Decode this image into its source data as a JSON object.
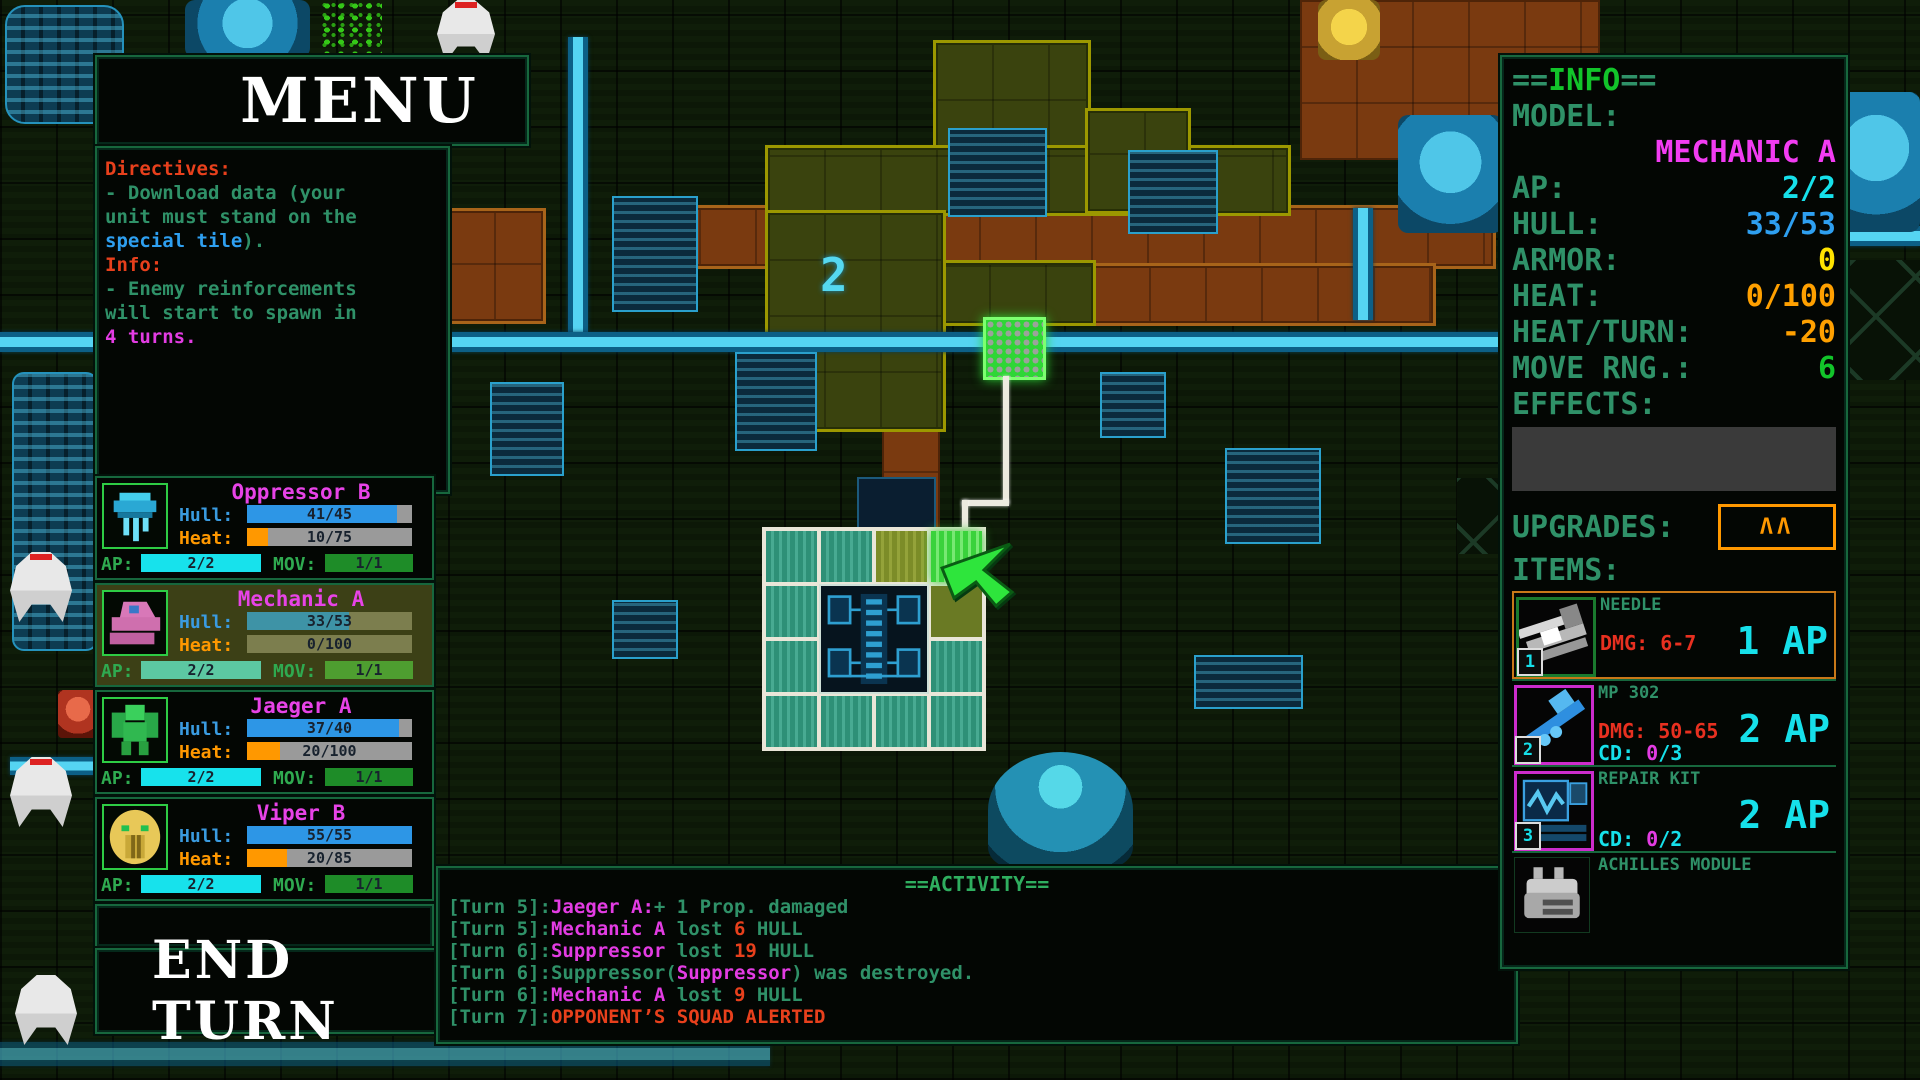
{
  "menu": {
    "title": "MENU"
  },
  "directives": {
    "lines": [
      [
        {
          "t": "Directives:",
          "c": "red"
        }
      ],
      [
        {
          "t": "- Download data (your",
          "c": "green"
        }
      ],
      [
        {
          "t": "unit must stand on the",
          "c": "green"
        }
      ],
      [
        {
          "t": "special tile",
          "c": "blue"
        },
        {
          "t": ").",
          "c": "green"
        }
      ],
      [
        {
          "t": "Info:",
          "c": "red"
        }
      ],
      [
        {
          "t": "- Enemy reinforcements",
          "c": "green"
        }
      ],
      [
        {
          "t": "will start to spawn in",
          "c": "green"
        }
      ],
      [
        {
          "t": "4 turns.",
          "c": "magenta"
        }
      ]
    ]
  },
  "squad": {
    "hull_label": "Hull:",
    "heat_label": "Heat:",
    "ap_label": "AP:",
    "mov_label": "MOV:",
    "units": [
      {
        "name": "Oppressor B",
        "sprite": "drone",
        "selected": false,
        "hull": {
          "text": "41/45",
          "pct": 91
        },
        "heat": {
          "text": "10/75",
          "pct": 13
        },
        "ap": {
          "text": "2/2",
          "pct": 100
        },
        "mov": {
          "text": "1/1",
          "pct": 100
        }
      },
      {
        "name": "Mechanic A",
        "sprite": "truck",
        "selected": true,
        "hull": {
          "text": "33/53",
          "pct": 62
        },
        "heat": {
          "text": "0/100",
          "pct": 0
        },
        "ap": {
          "text": "2/2",
          "pct": 100
        },
        "mov": {
          "text": "1/1",
          "pct": 100
        }
      },
      {
        "name": "Jaeger A",
        "sprite": "mech",
        "selected": false,
        "hull": {
          "text": "37/40",
          "pct": 92
        },
        "heat": {
          "text": "20/100",
          "pct": 20
        },
        "ap": {
          "text": "2/2",
          "pct": 100
        },
        "mov": {
          "text": "1/1",
          "pct": 100
        }
      },
      {
        "name": "Viper B",
        "sprite": "lion",
        "selected": false,
        "hull": {
          "text": "55/55",
          "pct": 100
        },
        "heat": {
          "text": "20/85",
          "pct": 24
        },
        "ap": {
          "text": "2/2",
          "pct": 100
        },
        "mov": {
          "text": "1/1",
          "pct": 100
        }
      }
    ]
  },
  "end_turn": {
    "label": "END TURN"
  },
  "activity": {
    "title": "==ACTIVITY==",
    "lines": [
      [
        {
          "t": "[Turn 5]:",
          "c": "green"
        },
        {
          "t": "Jaeger A:",
          "c": "magenta"
        },
        {
          "t": "+ 1 Prop. damaged",
          "c": "green"
        }
      ],
      [
        {
          "t": "[Turn 5]:",
          "c": "green"
        },
        {
          "t": "Mechanic A",
          "c": "magenta"
        },
        {
          "t": " lost ",
          "c": "green"
        },
        {
          "t": "6",
          "c": "red"
        },
        {
          "t": " HULL",
          "c": "green"
        }
      ],
      [
        {
          "t": "[Turn 6]:",
          "c": "green"
        },
        {
          "t": "Suppressor",
          "c": "magenta"
        },
        {
          "t": " lost ",
          "c": "green"
        },
        {
          "t": "19",
          "c": "red"
        },
        {
          "t": " HULL",
          "c": "green"
        }
      ],
      [
        {
          "t": "[Turn 6]:",
          "c": "green"
        },
        {
          "t": "Suppressor(",
          "c": "green"
        },
        {
          "t": "Suppressor",
          "c": "magenta"
        },
        {
          "t": ") was destroyed.",
          "c": "green"
        }
      ],
      [
        {
          "t": "[Turn 6]:",
          "c": "green"
        },
        {
          "t": "Mechanic A",
          "c": "magenta"
        },
        {
          "t": " lost ",
          "c": "green"
        },
        {
          "t": "9",
          "c": "red"
        },
        {
          "t": " HULL",
          "c": "green"
        }
      ],
      [
        {
          "t": "[Turn 7]:",
          "c": "green"
        },
        {
          "t": "OPPONENT’S SQUAD ALERTED",
          "c": "red"
        }
      ]
    ]
  },
  "info": {
    "header_pre": "==",
    "header_title": "INFO",
    "header_post": "==",
    "model_label": "MODEL:",
    "model_value": "MECHANIC A",
    "stats": [
      {
        "label": "AP:",
        "value": "2/2",
        "color": "cyan"
      },
      {
        "label": "HULL:",
        "value": "33/53",
        "color": "blue"
      },
      {
        "label": "ARMOR:",
        "value": "0",
        "color": "yellow"
      },
      {
        "label": "HEAT:",
        "value": "0/100",
        "color": "orange"
      },
      {
        "label": "HEAT/TURN:",
        "value": "-20",
        "color": "orange"
      },
      {
        "label": "MOVE RNG.:",
        "value": "6",
        "color": "bgreen"
      }
    ],
    "effects_label": "EFFECTS:",
    "upgrades_label": "UPGRADES:",
    "upgrades_badge": "ΛΛ",
    "items_label": "ITEMS:",
    "items": [
      {
        "name": "NEEDLE",
        "slot": "1",
        "dmg": "DMG: 6-7",
        "cd_segs": null,
        "ap": "1 AP",
        "selected": true,
        "icon_border": "green",
        "icon": "needle"
      },
      {
        "name": "MP 302",
        "slot": "2",
        "dmg": "DMG: 50-65",
        "cd_segs": [
          {
            "t": "CD: ",
            "c": "cyan"
          },
          {
            "t": "0",
            "c": "magenta"
          },
          {
            "t": "/3",
            "c": "cyan"
          }
        ],
        "ap": "2 AP",
        "selected": false,
        "icon_border": "magenta",
        "icon": "rifle"
      },
      {
        "name": "REPAIR KIT",
        "slot": "3",
        "dmg": null,
        "cd_segs": [
          {
            "t": "CD: ",
            "c": "cyan"
          },
          {
            "t": "0",
            "c": "magenta"
          },
          {
            "t": "/2",
            "c": "cyan"
          }
        ],
        "ap": "2 AP",
        "selected": false,
        "icon_border": "magenta",
        "icon": "monitor"
      },
      {
        "name": "ACHILLES MODULE",
        "slot": null,
        "dmg": null,
        "cd_segs": null,
        "ap": null,
        "selected": false,
        "icon_border": "none",
        "icon": "module"
      }
    ]
  },
  "map": {
    "graffiti": "2"
  },
  "colors": {
    "panel_border": "#17673d",
    "text_green": "#2f9168",
    "bright_green": "#12c42a",
    "red": "#e8401c",
    "magenta": "#e33ce3",
    "cyan": "#16e0ea",
    "blue": "#2e9ff0",
    "yellow": "#ffe400",
    "orange": "#ffa000",
    "hull_bar": "#2d96e6",
    "heat_bar": "#ff9800",
    "room_fill": "#3a430e",
    "room_border": "#9c9800",
    "corridor_fill": "#7a3a10",
    "pipe": "#55d4f2",
    "move_tile": "#2e9077",
    "cursor_green": "#2ee53c",
    "data_tile": "#2ed636"
  }
}
